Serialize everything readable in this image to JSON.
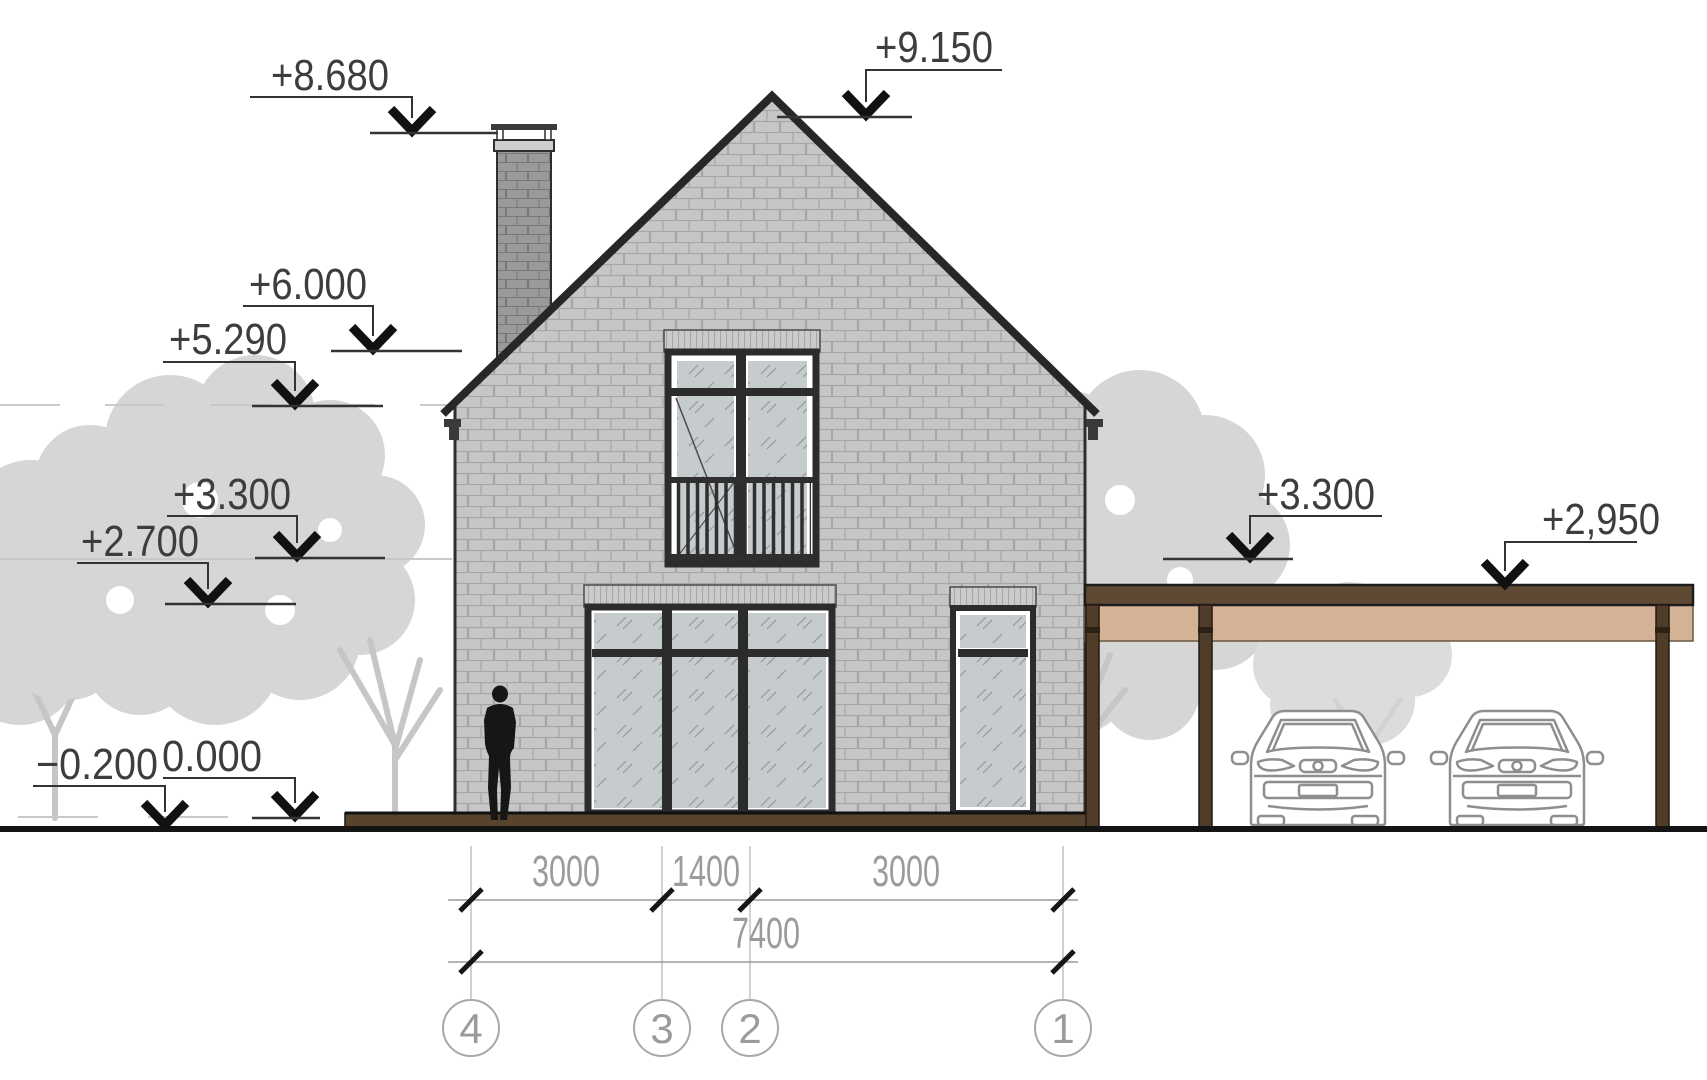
{
  "title": "House elevation drawing with carport",
  "markers": [
    {
      "id": "chimney-top",
      "label": "+8.680"
    },
    {
      "id": "roof-peak",
      "label": "+9.150"
    },
    {
      "id": "roof-upper",
      "label": "+6.000"
    },
    {
      "id": "eaves-level",
      "label": "+5.290"
    },
    {
      "id": "floor-left",
      "label": "+3.300"
    },
    {
      "id": "lintel-left",
      "label": "+2.700"
    },
    {
      "id": "ground-minus",
      "label": "−0.200"
    },
    {
      "id": "ground-zero",
      "label": "0.000"
    },
    {
      "id": "floor-right",
      "label": "+3.300"
    },
    {
      "id": "carport-roof",
      "label": "+2,950"
    }
  ],
  "dimensions": {
    "segments": [
      "3000",
      "1400",
      "3000"
    ],
    "total": "7400"
  },
  "axes": [
    "4",
    "3",
    "2",
    "1"
  ],
  "colors": {
    "brick_wall": "#c6c6c6",
    "brick_chimney": "#9a9a9a",
    "carport_wood_dark": "#5e4a33",
    "carport_wood_light": "#d4b295",
    "plinth_brown": "#58432f",
    "tree_gray": "#d6d6d6",
    "dim_gray": "#9b9b9b",
    "ink": "#2e2e2e"
  }
}
